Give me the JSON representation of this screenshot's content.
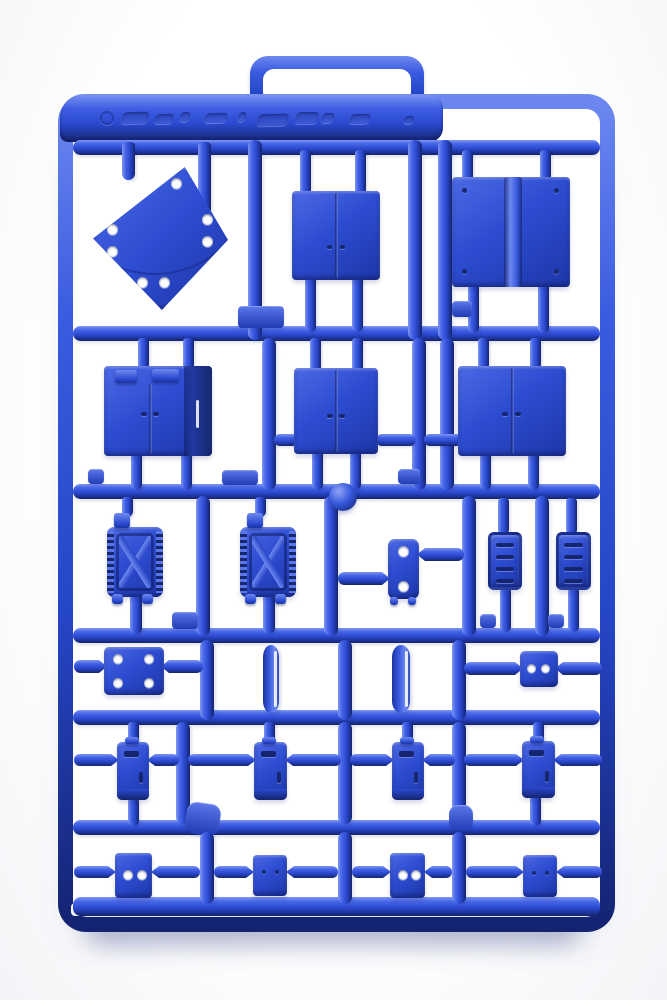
{
  "scene": {
    "type": "product photograph",
    "subject": "Blue injection-molded plastic model kit sprue (runner frame) with accessory parts on a white background",
    "background_color": "#ffffff",
    "plastic_base_color": "#2b4ccf",
    "plastic_highlight_color": "#7d95f2",
    "plastic_shadow_color": "#14236f"
  },
  "sprue": {
    "handle": "carry handle loop at top",
    "top_rail_embossing": "illegible raised embossed logo text",
    "gate_ball": "round injection gate knob on second rail",
    "row_count": 6,
    "part_count": 23
  },
  "parts": [
    {
      "name": "diamond base plate with eight holes"
    },
    {
      "name": "double door panel"
    },
    {
      "name": "hinged double panel with rivets"
    },
    {
      "name": "cabinet box with double doors"
    },
    {
      "name": "double door panel (medium)"
    },
    {
      "name": "double door panel (wide)"
    },
    {
      "name": "jerry can"
    },
    {
      "name": "jerry can"
    },
    {
      "name": "latch plate with two holes"
    },
    {
      "name": "vent grille"
    },
    {
      "name": "vent grille"
    },
    {
      "name": "mounting plate with four holes"
    },
    {
      "name": "curved blade strut"
    },
    {
      "name": "curved blade strut"
    },
    {
      "name": "connector plate with two holes"
    },
    {
      "name": "small hatch door"
    },
    {
      "name": "small hatch door"
    },
    {
      "name": "small hatch door"
    },
    {
      "name": "small hatch door"
    },
    {
      "name": "square plate with two holes"
    },
    {
      "name": "square plate (plain)"
    },
    {
      "name": "square plate with two holes"
    },
    {
      "name": "square plate (plain)"
    }
  ]
}
